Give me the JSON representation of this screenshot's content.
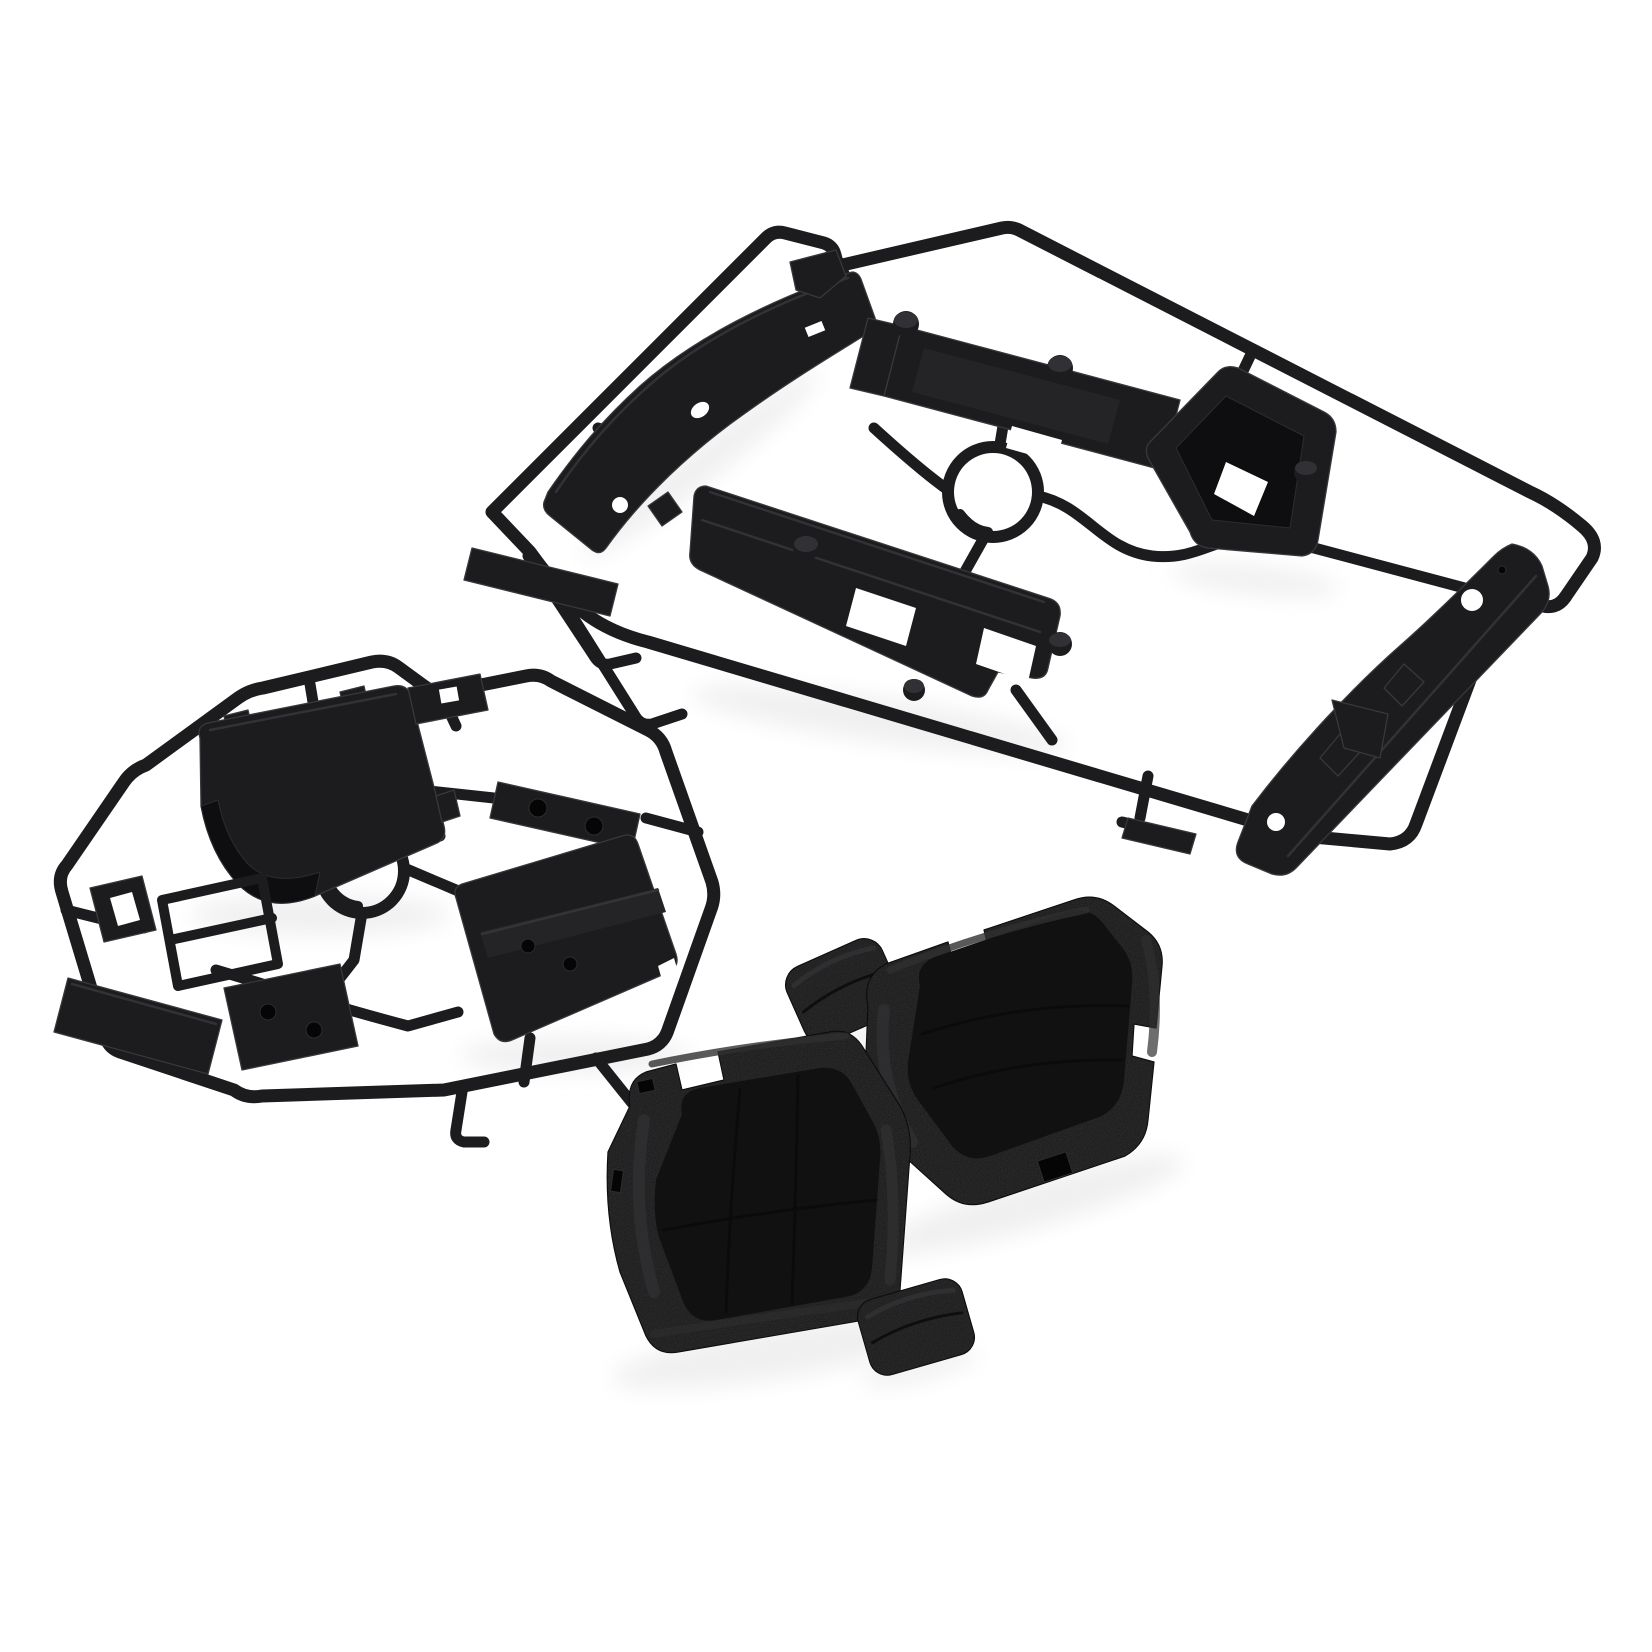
{
  "meta": {
    "type": "product-photo",
    "description": "Product photo: two black injection-molded plastic parts trees (sprues) holding RC car interior components, plus four textured black foam seat cushion pieces (two seat pads and two headrest pads), arranged on a plain white background.",
    "background": "#ffffff"
  },
  "colors": {
    "plastic": "#1c1c1e",
    "plastic-face": "#242427",
    "plastic-dark": "#0e0e10",
    "plastic-highlight": "#38383c",
    "foam": "#161617",
    "foam-panel": "#111112",
    "foam-highlight": "#2f2f31",
    "foam-seam": "#0a0a0b",
    "shadow": "#e4e4e4",
    "background": "#ffffff"
  },
  "parts": {
    "sprue_a": {
      "label": "interior parts tree A (upper right)",
      "pieces": [
        "dashboard trim strip",
        "seat rail tray",
        "storage bin",
        "console box",
        "side sill strip",
        "corner bar",
        "small hook piece",
        "small flag piece"
      ]
    },
    "sprue_b": {
      "label": "interior parts tree B (lower left)",
      "pieces": [
        "console lid",
        "mounting bar with bosses",
        "seat base plate",
        "bracket block",
        "window frame bracket",
        "two-hole plate",
        "flat strip",
        "small block"
      ]
    },
    "foam_set": {
      "label": "foam seat cushion set (lower middle)",
      "pieces": [
        "headrest pad upper",
        "seat back cushion right",
        "seat bottom cushion left",
        "headrest pad lower"
      ]
    }
  }
}
